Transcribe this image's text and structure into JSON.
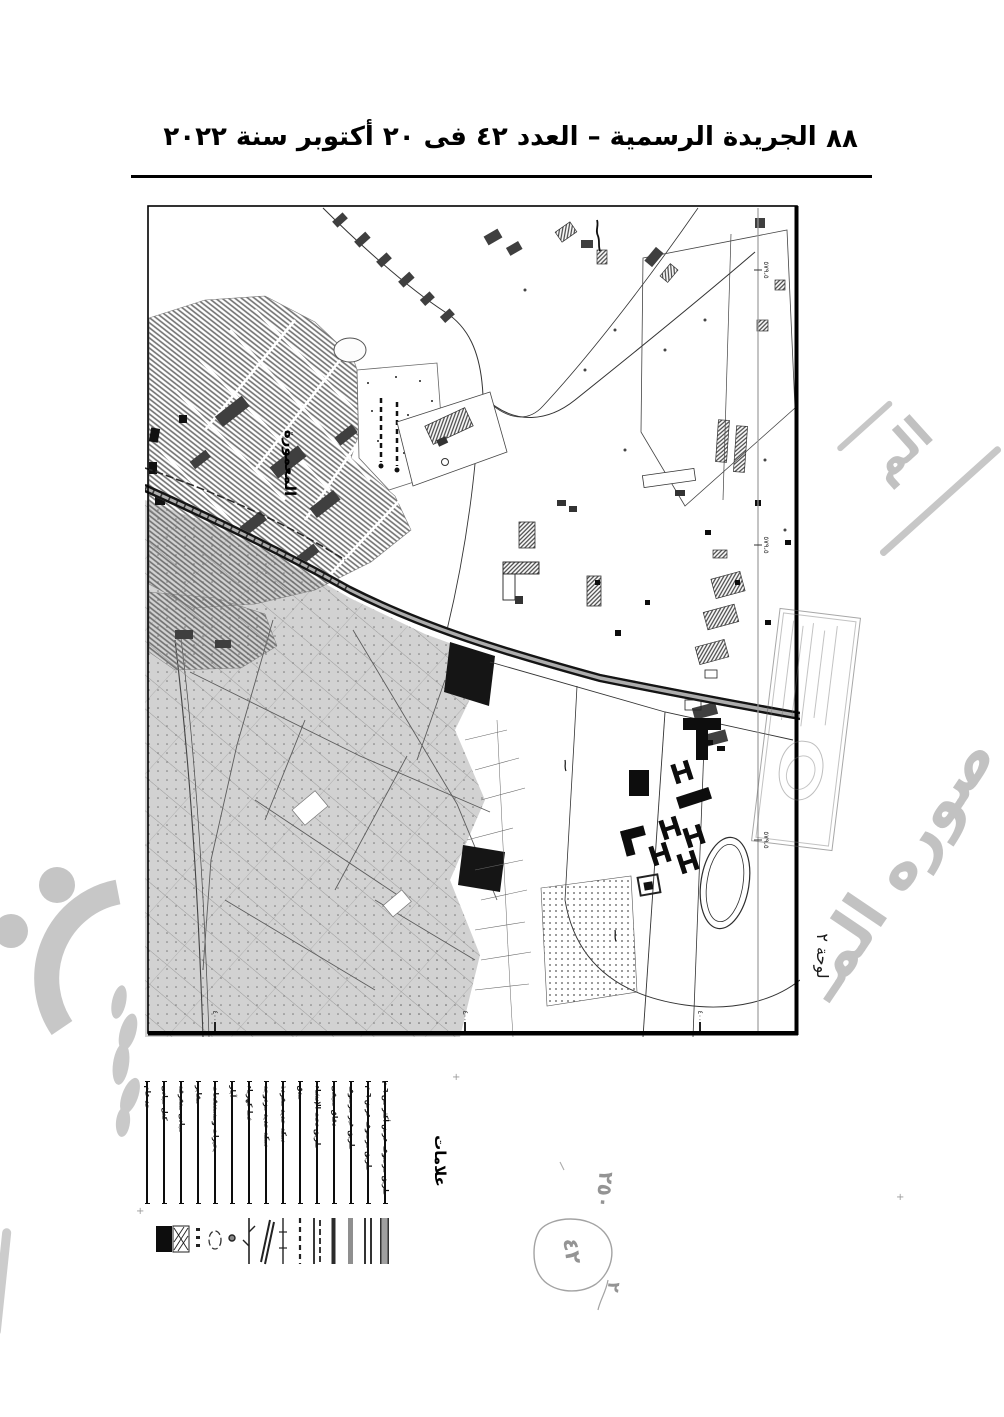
{
  "page": {
    "header": "الجريدة الرسمية – العدد ٤٢ فى ٢٠ أكتوبر سنة ٢٠٢٢",
    "number": "٨٨"
  },
  "map": {
    "district_label": "المعمورة",
    "sheet_note": "لوحة ٢",
    "grid_labels": [
      "٥٧٩،٥",
      "٥٧٩،٥",
      "٥٧٩،٥"
    ],
    "bottom_ticks": [
      "٤٠٠",
      "٤٠٠",
      "٤٠٠"
    ]
  },
  "legend": {
    "title": "علامات",
    "items": [
      {
        "label": "طريق مرصوف عرض أكثر من ٦ م",
        "symbol": "bar-thick-gray"
      },
      {
        "label": "طريق مرصوف عرض ٦ م",
        "symbol": "bar-double-thin"
      },
      {
        "label": "طريق غير مرصوف",
        "symbol": "bar-gray"
      },
      {
        "label": "دقاق صيفى",
        "symbol": "bar-solid"
      },
      {
        "label": "طريق تحت الإنشاء",
        "symbol": "bar-pair"
      },
      {
        "label": "مدق",
        "symbol": "bar-dashed"
      },
      {
        "label": "سكة حديد مفردة",
        "symbol": "line-ticks"
      },
      {
        "label": "سكة حديد مزدوجة",
        "symbol": "diagonal-double"
      },
      {
        "label": "خط كهرباء",
        "symbol": "line-branch"
      },
      {
        "label": "آبار",
        "symbol": "dot"
      },
      {
        "label": "بحيرات ومستنقعات",
        "symbol": "ellipse-outline"
      },
      {
        "label": "مقابر",
        "symbol": "small-marks"
      },
      {
        "label": "مبانى متفرقة",
        "symbol": "square-hatched"
      },
      {
        "label": "كتل مبانى",
        "symbol": "square-solid"
      },
      {
        "label": "حد عام",
        "symbol": "none"
      }
    ]
  },
  "annotations": {
    "handwritten_number": "٢٥٠",
    "circled_number": "٤٢",
    "small_number": "٢"
  },
  "watermark": {
    "fragment_top": "الم",
    "fragment_bottom": "صوره المـ"
  },
  "colors": {
    "ink": "#000000",
    "map_gray": "#d2d2d2",
    "watermark_gray": "#c2c2c2",
    "pencil_gray": "#949494"
  }
}
